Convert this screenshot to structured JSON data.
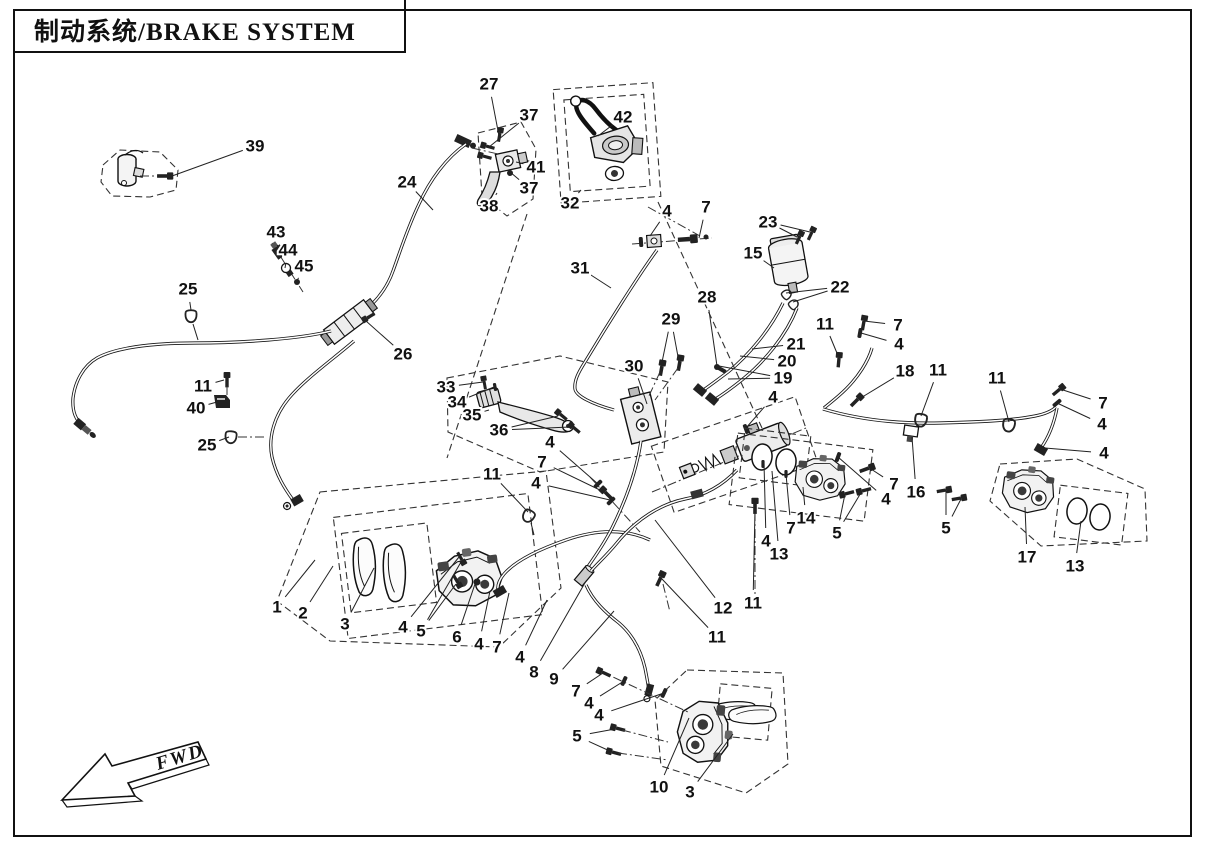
{
  "page": {
    "title": "制动系统/BRAKE SYSTEM",
    "fwd_label": "FWD"
  },
  "colors": {
    "ink": "#161616",
    "background": "#ffffff"
  },
  "diagram": {
    "description": "Exploded parts diagram of brake system with numbered callouts",
    "callouts": [
      {
        "t": "39",
        "x": 255,
        "y": 146,
        "leaders": [
          [
            172,
            176
          ]
        ]
      },
      {
        "t": "27",
        "x": 489,
        "y": 84,
        "leaders": [
          [
            499,
            136
          ]
        ]
      },
      {
        "t": "37",
        "x": 529,
        "y": 115,
        "leaders": [
          [
            489,
            147
          ]
        ]
      },
      {
        "t": "42",
        "x": 623,
        "y": 117,
        "leaders": [
          [
            598,
            136
          ]
        ]
      },
      {
        "t": "41",
        "x": 536,
        "y": 167,
        "leaders": [
          [
            516,
            162
          ]
        ]
      },
      {
        "t": "37",
        "x": 529,
        "y": 188,
        "leaders": [
          [
            510,
            172
          ]
        ]
      },
      {
        "t": "38",
        "x": 489,
        "y": 206,
        "leaders": [
          [
            497,
            193
          ]
        ]
      },
      {
        "t": "32",
        "x": 570,
        "y": 203,
        "leaders": [
          [
            581,
            190
          ]
        ]
      },
      {
        "t": "24",
        "x": 407,
        "y": 182,
        "leaders": [
          [
            433,
            210
          ]
        ]
      },
      {
        "t": "4",
        "x": 667,
        "y": 211,
        "leaders": [
          [
            650,
            236
          ]
        ]
      },
      {
        "t": "7",
        "x": 706,
        "y": 207,
        "leaders": [
          [
            699,
            238
          ]
        ]
      },
      {
        "t": "23",
        "x": 768,
        "y": 222,
        "leaders": [
          [
            797,
            237
          ],
          [
            810,
            232
          ]
        ]
      },
      {
        "t": "15",
        "x": 753,
        "y": 253,
        "leaders": [
          [
            774,
            268
          ]
        ]
      },
      {
        "t": "22",
        "x": 840,
        "y": 287,
        "leaders": [
          [
            786,
            293
          ],
          [
            793,
            302
          ]
        ]
      },
      {
        "t": "31",
        "x": 580,
        "y": 268,
        "leaders": [
          [
            611,
            288
          ]
        ]
      },
      {
        "t": "28",
        "x": 707,
        "y": 297,
        "leaders": [
          [
            717,
            366
          ]
        ]
      },
      {
        "t": "29",
        "x": 671,
        "y": 319,
        "leaders": [
          [
            661,
            367
          ],
          [
            679,
            362
          ]
        ]
      },
      {
        "t": "43",
        "x": 276,
        "y": 232,
        "leaders": [
          [
            278,
            250
          ]
        ]
      },
      {
        "t": "44",
        "x": 288,
        "y": 250,
        "leaders": [
          [
            285,
            268
          ]
        ]
      },
      {
        "t": "45",
        "x": 304,
        "y": 266,
        "leaders": [
          [
            297,
            281
          ]
        ]
      },
      {
        "t": "25",
        "x": 188,
        "y": 289,
        "leaders": [
          [
            191,
            310
          ]
        ]
      },
      {
        "t": "26",
        "x": 403,
        "y": 354,
        "leaders": [
          [
            366,
            321
          ]
        ]
      },
      {
        "t": "11",
        "x": 203,
        "y": 386,
        "leaders": [
          [
            224,
            380
          ]
        ]
      },
      {
        "t": "40",
        "x": 196,
        "y": 408,
        "leaders": [
          [
            217,
            402
          ]
        ]
      },
      {
        "t": "25",
        "x": 207,
        "y": 445,
        "leaders": [
          [
            229,
            437
          ]
        ]
      },
      {
        "t": "30",
        "x": 634,
        "y": 366,
        "leaders": [
          [
            647,
            404
          ]
        ]
      },
      {
        "t": "33",
        "x": 446,
        "y": 387,
        "leaders": [
          [
            483,
            382
          ]
        ]
      },
      {
        "t": "34",
        "x": 457,
        "y": 402,
        "leaders": [
          [
            494,
            387
          ]
        ]
      },
      {
        "t": "35",
        "x": 472,
        "y": 415,
        "leaders": [
          [
            489,
            410
          ]
        ]
      },
      {
        "t": "36",
        "x": 499,
        "y": 430,
        "leaders": [
          [
            558,
            416
          ],
          [
            570,
            427
          ]
        ]
      },
      {
        "t": "21",
        "x": 796,
        "y": 344,
        "leaders": [
          [
            752,
            349
          ]
        ]
      },
      {
        "t": "20",
        "x": 787,
        "y": 361,
        "leaders": [
          [
            740,
            356
          ]
        ]
      },
      {
        "t": "19",
        "x": 783,
        "y": 378,
        "leaders": [
          [
            719,
            366
          ],
          [
            728,
            379
          ]
        ]
      },
      {
        "t": "4",
        "x": 773,
        "y": 397,
        "leaders": [
          [
            746,
            428
          ]
        ]
      },
      {
        "t": "11",
        "x": 825,
        "y": 324,
        "leaders": [
          [
            839,
            358
          ]
        ]
      },
      {
        "t": "7",
        "x": 898,
        "y": 325,
        "leaders": [
          [
            864,
            321
          ]
        ]
      },
      {
        "t": "4",
        "x": 899,
        "y": 344,
        "leaders": [
          [
            861,
            333
          ]
        ]
      },
      {
        "t": "18",
        "x": 905,
        "y": 371,
        "leaders": [
          [
            859,
            399
          ]
        ]
      },
      {
        "t": "11",
        "x": 938,
        "y": 370,
        "leaders": [
          [
            921,
            416
          ]
        ]
      },
      {
        "t": "11",
        "x": 997,
        "y": 378,
        "leaders": [
          [
            1009,
            422
          ]
        ]
      },
      {
        "t": "7",
        "x": 1103,
        "y": 403,
        "leaders": [
          [
            1060,
            389
          ]
        ]
      },
      {
        "t": "4",
        "x": 1102,
        "y": 424,
        "leaders": [
          [
            1057,
            403
          ]
        ]
      },
      {
        "t": "4",
        "x": 1104,
        "y": 453,
        "leaders": [
          [
            1045,
            448
          ]
        ]
      },
      {
        "t": "16",
        "x": 916,
        "y": 492,
        "leaders": [
          [
            912,
            437
          ]
        ]
      },
      {
        "t": "7",
        "x": 894,
        "y": 484,
        "leaders": [
          [
            871,
            469
          ]
        ]
      },
      {
        "t": "4",
        "x": 886,
        "y": 499,
        "leaders": [
          [
            838,
            457
          ]
        ]
      },
      {
        "t": "14",
        "x": 806,
        "y": 518,
        "leaders": [
          [
            803,
            487
          ]
        ]
      },
      {
        "t": "7",
        "x": 791,
        "y": 528,
        "leaders": [
          [
            786,
            474
          ]
        ]
      },
      {
        "t": "5",
        "x": 837,
        "y": 533,
        "leaders": [
          [
            845,
            494
          ],
          [
            862,
            491
          ]
        ]
      },
      {
        "t": "5",
        "x": 946,
        "y": 528,
        "leaders": [
          [
            946,
            491
          ],
          [
            961,
            499
          ]
        ]
      },
      {
        "t": "4",
        "x": 766,
        "y": 541,
        "leaders": [
          [
            764,
            463
          ]
        ]
      },
      {
        "t": "13",
        "x": 779,
        "y": 554,
        "leaders": [
          [
            772,
            471
          ]
        ]
      },
      {
        "t": "17",
        "x": 1027,
        "y": 557,
        "leaders": [
          [
            1025,
            507
          ]
        ]
      },
      {
        "t": "13",
        "x": 1075,
        "y": 566,
        "leaders": [
          [
            1081,
            521
          ]
        ]
      },
      {
        "t": "12",
        "x": 723,
        "y": 608,
        "leaders": [
          [
            655,
            520
          ]
        ]
      },
      {
        "t": "11",
        "x": 753,
        "y": 603,
        "leaders": [
          [
            755,
            509
          ]
        ]
      },
      {
        "t": "11",
        "x": 717,
        "y": 637,
        "leaders": [
          [
            662,
            579
          ]
        ]
      },
      {
        "t": "11",
        "x": 492,
        "y": 474,
        "leaders": [
          [
            528,
            512
          ]
        ]
      },
      {
        "t": "4",
        "x": 550,
        "y": 442,
        "leaders": [
          [
            598,
            484
          ]
        ]
      },
      {
        "t": "7",
        "x": 542,
        "y": 462,
        "leaders": [
          [
            604,
            492
          ]
        ]
      },
      {
        "t": "4",
        "x": 536,
        "y": 483,
        "leaders": [
          [
            610,
            500
          ]
        ]
      },
      {
        "t": "1",
        "x": 277,
        "y": 607,
        "leaders": [
          [
            315,
            560
          ]
        ]
      },
      {
        "t": "2",
        "x": 303,
        "y": 613,
        "leaders": [
          [
            333,
            566
          ]
        ]
      },
      {
        "t": "3",
        "x": 345,
        "y": 624,
        "leaders": [
          [
            374,
            568
          ]
        ]
      },
      {
        "t": "4",
        "x": 403,
        "y": 627,
        "leaders": [
          [
            459,
            557
          ]
        ]
      },
      {
        "t": "5",
        "x": 421,
        "y": 631,
        "leaders": [
          [
            461,
            562
          ],
          [
            456,
            584
          ]
        ]
      },
      {
        "t": "6",
        "x": 457,
        "y": 637,
        "leaders": [
          [
            476,
            581
          ]
        ]
      },
      {
        "t": "4",
        "x": 479,
        "y": 644,
        "leaders": [
          [
            490,
            591
          ]
        ]
      },
      {
        "t": "7",
        "x": 497,
        "y": 647,
        "leaders": [
          [
            509,
            593
          ]
        ]
      },
      {
        "t": "4",
        "x": 520,
        "y": 657,
        "leaders": [
          [
            547,
            600
          ]
        ]
      },
      {
        "t": "8",
        "x": 534,
        "y": 672,
        "leaders": [
          [
            586,
            581
          ]
        ]
      },
      {
        "t": "9",
        "x": 554,
        "y": 679,
        "leaders": [
          [
            614,
            611
          ]
        ]
      },
      {
        "t": "7",
        "x": 576,
        "y": 691,
        "leaders": [
          [
            603,
            673
          ]
        ]
      },
      {
        "t": "4",
        "x": 589,
        "y": 703,
        "leaders": [
          [
            624,
            681
          ]
        ]
      },
      {
        "t": "4",
        "x": 599,
        "y": 715,
        "leaders": [
          [
            664,
            693
          ]
        ]
      },
      {
        "t": "5",
        "x": 577,
        "y": 736,
        "leaders": [
          [
            615,
            729
          ],
          [
            612,
            752
          ]
        ]
      },
      {
        "t": "10",
        "x": 659,
        "y": 787,
        "leaders": [
          [
            689,
            718
          ]
        ]
      },
      {
        "t": "3",
        "x": 690,
        "y": 792,
        "leaders": [
          [
            733,
            734
          ]
        ]
      }
    ]
  }
}
